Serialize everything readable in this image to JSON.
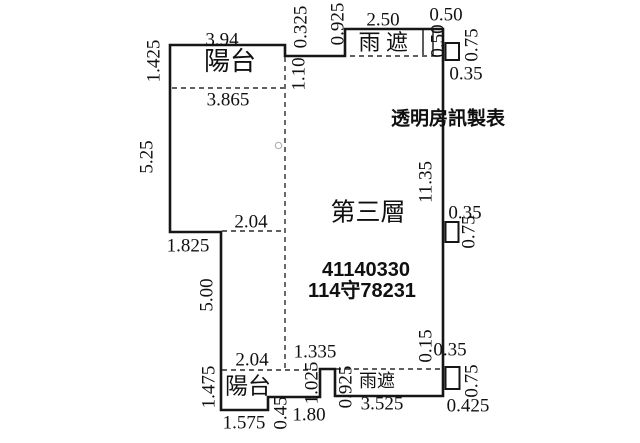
{
  "title": "第三層",
  "maker": "透明房訊製表",
  "ids": {
    "line1": "41140330",
    "line2": "114守78231"
  },
  "rooms": {
    "balcony_top": "陽台",
    "canopy_top": "雨遮",
    "balcony_bottom": "陽台",
    "canopy_bottom": "雨遮"
  },
  "dims": {
    "balcony_top_width": "3.94",
    "balcony_top_inner": "3.865",
    "balcony_top_left": "1.425",
    "left_wall_upper": "5.25",
    "step_top": "0.325",
    "balcony_top_depth": "1.10",
    "canopy_top_rise": "0.925",
    "canopy_top_width": "2.50",
    "canopy_top_end": "0.50",
    "box_tr_width": "0.50",
    "box_tr_height": "0.75",
    "box_tr_below": "0.35",
    "right_wall": "11.35",
    "box_mr_width": "0.35",
    "box_mr_height": "0.75",
    "ledge_top": "2.04",
    "ledge_width": "1.825",
    "left_wall_lower": "5.00",
    "balcony_bot_top_left": "2.04",
    "balcony_bot_top_right": "1.335",
    "balcony_bot_left": "1.475",
    "balcony_bot_bottom": "1.575",
    "step_bot": "0.45",
    "bottom_wall": "1.80",
    "pillar_height": "1.025",
    "canopy_bot_left": "0.925",
    "canopy_bot_width": "3.525",
    "wall_gap": "0.15",
    "box_br_top": "0.35",
    "box_br_height": "0.75",
    "box_br_width": "0.425"
  },
  "colors": {
    "ink": "#161616",
    "background": "#ffffff"
  }
}
